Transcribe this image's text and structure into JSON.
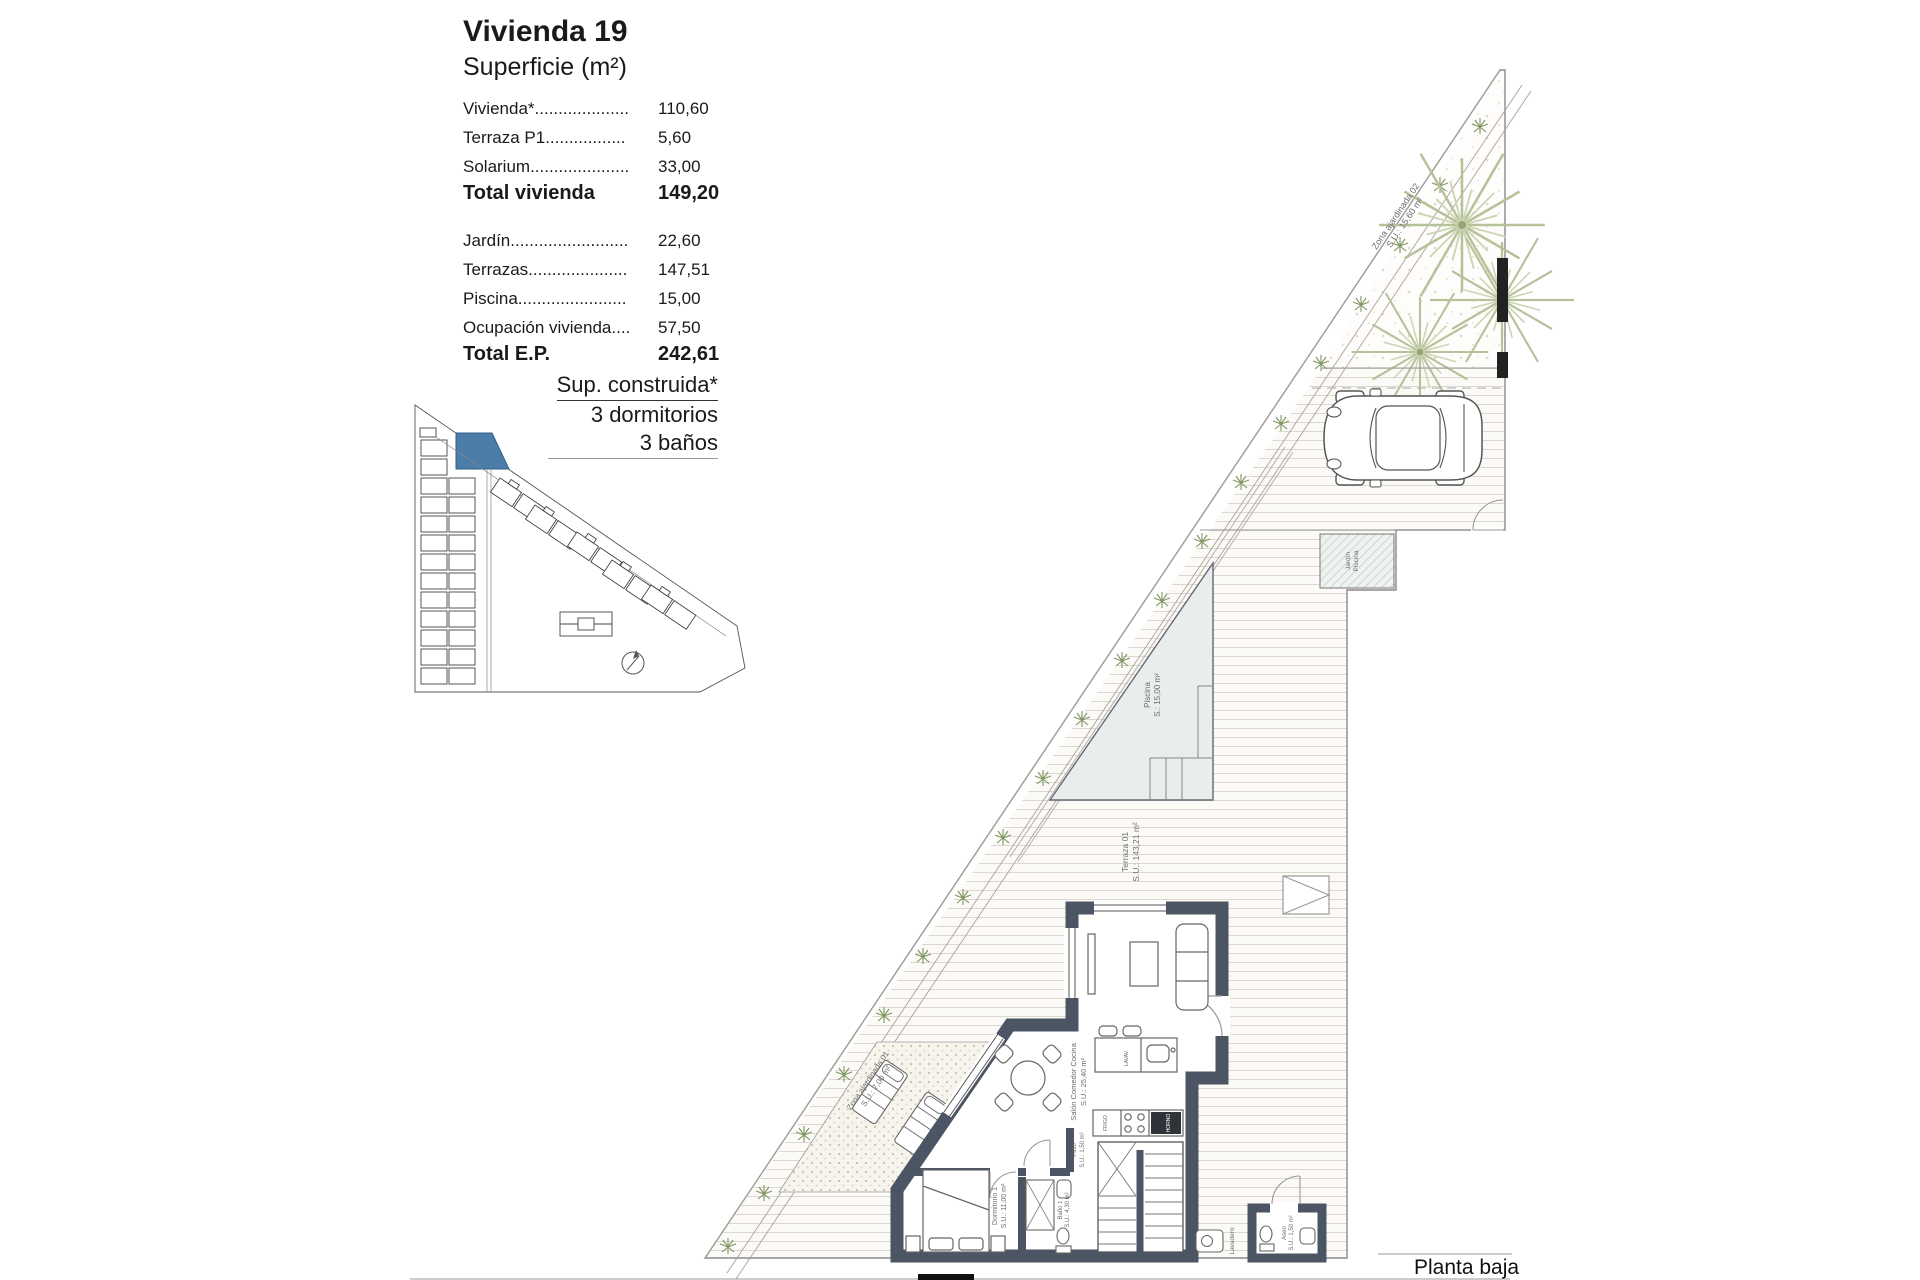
{
  "header": {
    "title": "Vivienda 19",
    "subtitle": "Superficie (m²)"
  },
  "surface_table": {
    "rows_vivienda": [
      {
        "label": "Vivienda*....................",
        "value": "110,60"
      },
      {
        "label": "Terraza P1.................",
        "value": "5,60"
      },
      {
        "label": "Solarium.....................",
        "value": "33,00"
      }
    ],
    "total_vivienda": {
      "label": "Total vivienda",
      "value": "149,20"
    },
    "rows_parcela": [
      {
        "label": "Jardín.........................",
        "value": "22,60"
      },
      {
        "label": "Terrazas.....................",
        "value": "147,51"
      },
      {
        "label": "Piscina.......................",
        "value": "15,00"
      },
      {
        "label": "Ocupación vivienda....",
        "value": "57,50"
      }
    ],
    "total_ep": {
      "label": "Total E.P.",
      "value": "242,61"
    }
  },
  "construida": {
    "line1": "Sup. construida*",
    "line2": "3 dormitorios",
    "line3": "3 baños"
  },
  "plan": {
    "zona_ajardinada_02": {
      "name": "Zona ajardinada 02",
      "area": "S.U.: 15,60 m²"
    },
    "jardin_piscina": {
      "line1": "Jardín",
      "line2": "Piscina"
    },
    "piscina": {
      "name": "Piscina",
      "area": "S.: 15,00 m²"
    },
    "terraza": {
      "name": "Terraza 01",
      "area": "S.U.: 143,21 m²"
    },
    "salon": {
      "name": "Salón Comedor Cocina",
      "area": "S.U.: 25,40 m²"
    },
    "zona_ajardinada_01": {
      "name": "Zona ajardinada 01",
      "area": "S.U.: 7,00 m²"
    },
    "dormitorio": {
      "name": "Dormitorio 1",
      "area": "S.U.: 11,00 m²"
    },
    "paso": {
      "name": "Paso",
      "area": "S.U.: 1,50 m²"
    },
    "bano": {
      "name": "Baño 1",
      "area": "S.U.: 4,30 m²"
    },
    "aseo": {
      "name": "Aseo",
      "area": "S.U.: 1,50 m²"
    },
    "lavadero": "Lavadero",
    "kitchen": {
      "frigo": "FRIGO",
      "horno": "HORNO",
      "lavavajillas": "LAVAV."
    }
  },
  "footer": {
    "label": "Planta baja"
  },
  "colors": {
    "highlight_unit_blue": "#4C7CA8",
    "wall_dark": "#4B5563",
    "plant_green": "#7F9663",
    "palm_green": "#B6C29A",
    "pool_fill": "#E9EEEC"
  }
}
